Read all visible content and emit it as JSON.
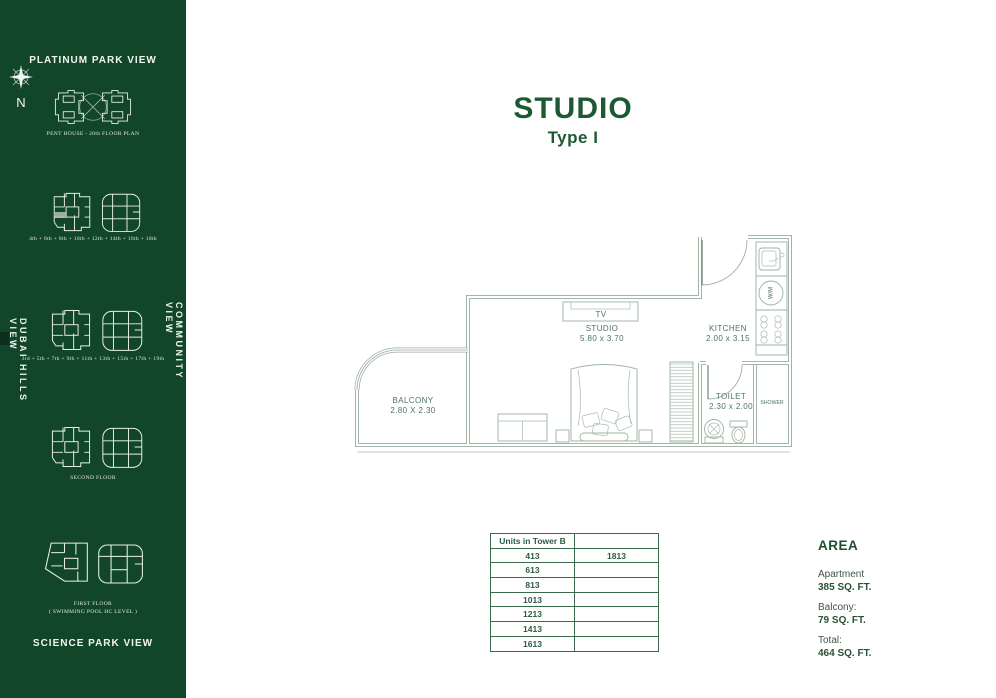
{
  "sidebar": {
    "top_title": "PLATINUM PARK VIEW",
    "bottom_title": "SCIENCE PARK VIEW",
    "left_vertical": "DUBAI HILLS  VIEW",
    "right_vertical": "COMMUNITY  VIEW",
    "compass_label": "N",
    "diagrams": [
      {
        "label": "PENT HOUSE - 20th FLOOR PLAN"
      },
      {
        "label": "4th + 6th + 8th + 10th + 12th + 14th + 16th + 18th"
      },
      {
        "label": "3rd + 5th + 7th + 9th + 11th + 13th + 15th + 17th + 19th"
      },
      {
        "label": "SECOND FLOOR"
      },
      {
        "label": "FIRST FLOOR",
        "label2": "( SWIMMING POOL HC LEVEL )"
      }
    ]
  },
  "header": {
    "title": "STUDIO",
    "subtitle": "Type I"
  },
  "floor_plan": {
    "rooms": [
      {
        "name": "BALCONY",
        "dims": "2.80 X 2.30"
      },
      {
        "name": "STUDIO",
        "dims": "5.80 x 3.70"
      },
      {
        "name": "KITCHEN",
        "dims": "2.00 x 3.15"
      },
      {
        "name": "TOILET",
        "dims": "2.30 x 2.00"
      },
      {
        "name": "SHOWER"
      }
    ],
    "labels": {
      "tv": "TV",
      "wm": "W/M"
    }
  },
  "units_table": {
    "header": "Units in Tower B",
    "rows": [
      [
        "413",
        "1813"
      ],
      [
        "613",
        ""
      ],
      [
        "813",
        ""
      ],
      [
        "1013",
        ""
      ],
      [
        "1213",
        ""
      ],
      [
        "1413",
        ""
      ],
      [
        "1613",
        ""
      ]
    ]
  },
  "area": {
    "title": "AREA",
    "items": [
      {
        "label": "Apartment",
        "value": "385 SQ. FT."
      },
      {
        "label": "Balcony:",
        "value": "79 SQ. FT."
      },
      {
        "label": "Total:",
        "value": "464 SQ. FT."
      }
    ]
  },
  "colors": {
    "sidebar_bg": "#124629",
    "accent_green": "#1d5a33",
    "plan_line": "#97ab9c"
  }
}
